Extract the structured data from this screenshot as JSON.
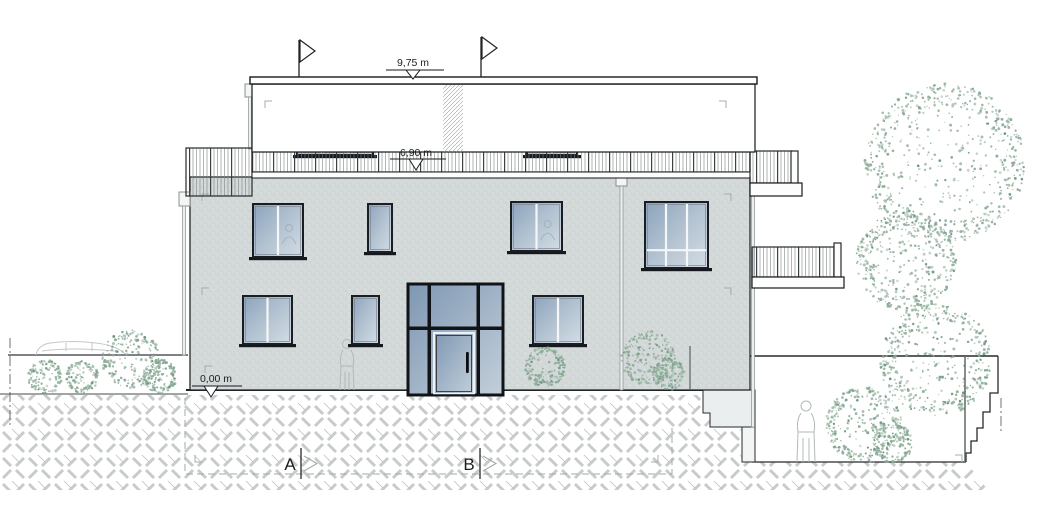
{
  "annotations": {
    "dim_roof": "9,75 m",
    "dim_terrace": "6,90 m",
    "dim_ground": "0,00 m",
    "marker_a": "A",
    "marker_b": "B"
  },
  "colors": {
    "facade": "#d3d8d8",
    "glass_dark": "#8ca3bc",
    "glass_mid": "#b6c5d3",
    "glass_light": "#d4dde4",
    "door_glass": "#7e97b2",
    "tree_green": "#8aae93",
    "tree_green_dark": "#6d9681",
    "tree_gray": "#97a4aa",
    "earth_hatch": "#c7cbcb",
    "figure_gray": "#b2b9b9",
    "line_dark": "#1d2023"
  }
}
